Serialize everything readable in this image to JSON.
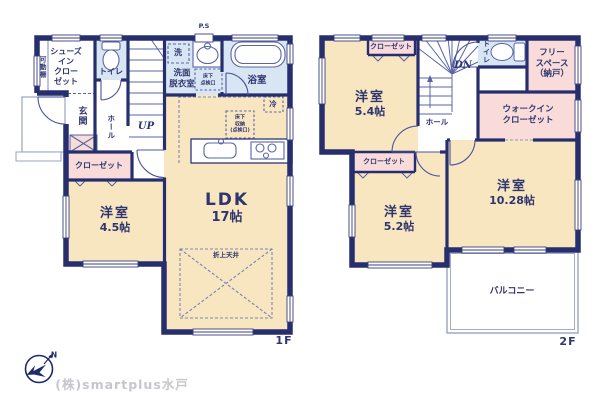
{
  "palette": {
    "wall_navy": "#262e6e",
    "room_cream": "#f8e6c0",
    "closet_pink": "#f9dcda",
    "wet_area_blue": "#d8e6f3",
    "text_navy": "#2e356f",
    "balcony_gray": "#9aa3c2",
    "company_gray": "#c6c7cc"
  },
  "floor1": {
    "label": "1F",
    "rooms": {
      "ldk": {
        "name": "LDK",
        "size": "17帖"
      },
      "western": {
        "name": "洋室",
        "size": "4.5帖"
      },
      "closet": "クローゼット",
      "shoes_closet": "シューズ\nイン\nクロー\nゼット",
      "movable_shelf": "可動棚",
      "entrance": "玄関",
      "hall": "ホール",
      "toilet": "トイレ",
      "washroom": "洗面\n脱衣室",
      "bathroom": "浴室",
      "washer": "洗",
      "fridge": "冷",
      "pipe_space": "P.S",
      "underfloor_access": "床下\n点検口",
      "underfloor_storage": "床下\n収納\n(点検口)",
      "coffered_ceiling": "折上天井",
      "stairs": "UP"
    }
  },
  "floor2": {
    "label": "2F",
    "rooms": {
      "western_a": {
        "name": "洋室",
        "size": "5.4帖"
      },
      "western_b": {
        "name": "洋室",
        "size": "5.2帖"
      },
      "western_c": {
        "name": "洋室",
        "size": "10.28帖"
      },
      "closet_a": "クローゼット",
      "closet_b": "クローゼット",
      "walk_in_closet": "ウォークイン\nクローゼット",
      "free_space": "フリー\nスペース\n（納戸）",
      "toilet": "トイレ",
      "hall": "ホール",
      "stairs": "DN",
      "balcony": "バルコニー"
    }
  },
  "footer": {
    "company": "(株)smartplus水戸",
    "compass_north": "N"
  }
}
